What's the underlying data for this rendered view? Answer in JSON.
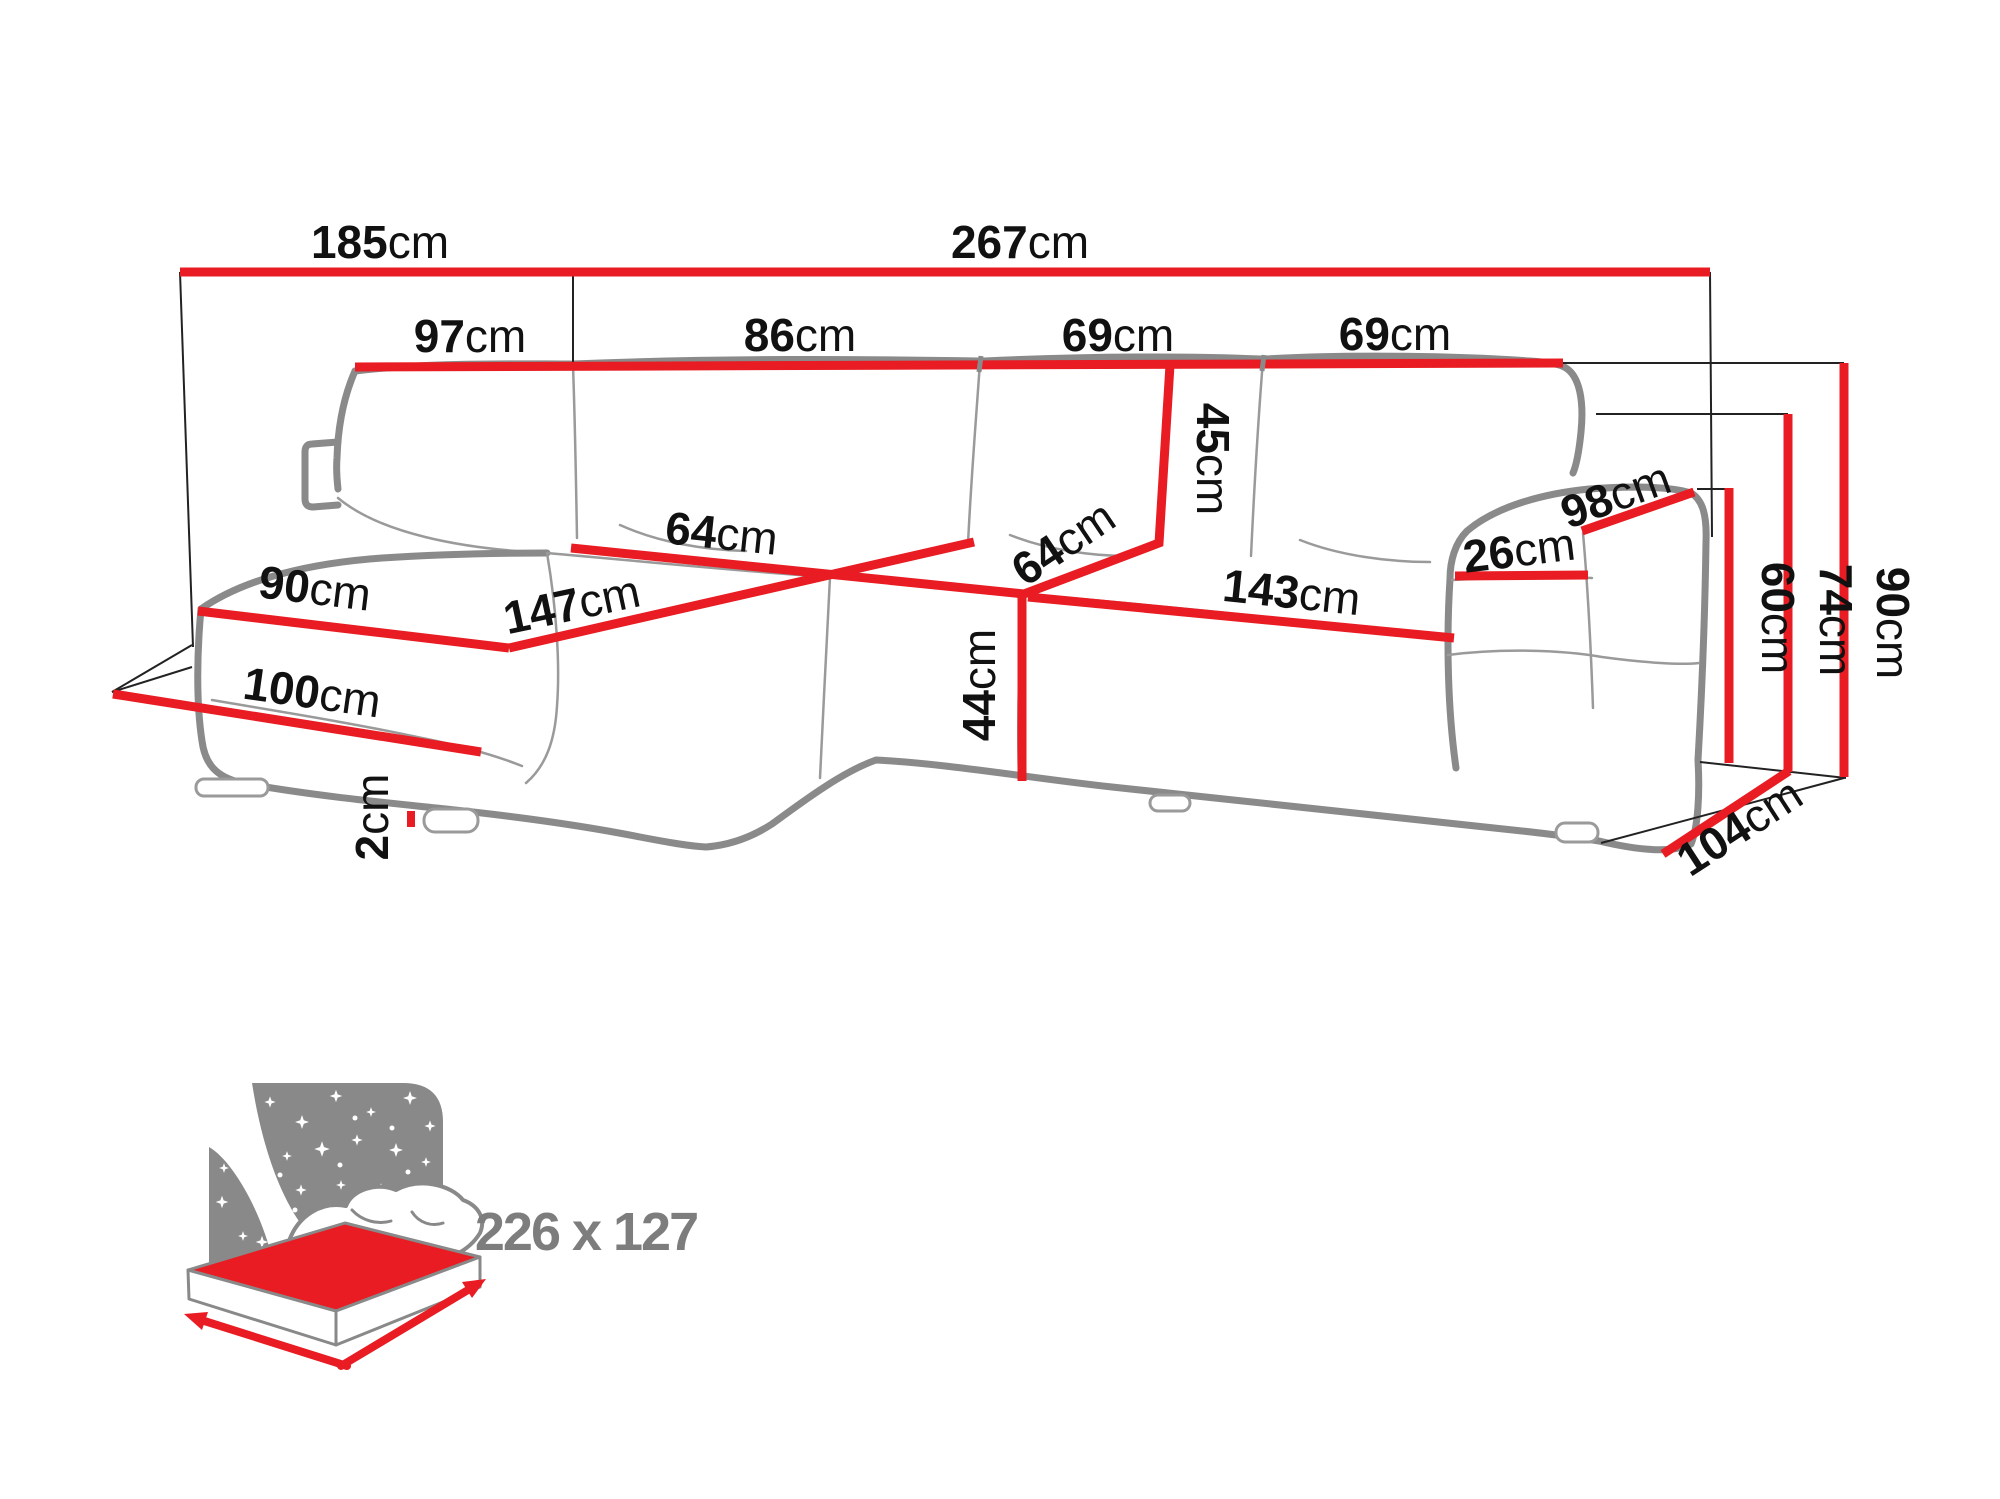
{
  "diagram": {
    "title": "corner sofa dimensions",
    "unit_system": "cm",
    "dimensions": [
      {
        "value": "185",
        "unit": "cm"
      },
      {
        "value": "267",
        "unit": "cm"
      },
      {
        "value": "97",
        "unit": "cm"
      },
      {
        "value": "86",
        "unit": "cm"
      },
      {
        "value": "69",
        "unit": "cm"
      },
      {
        "value": "69",
        "unit": "cm"
      },
      {
        "value": "45",
        "unit": "cm"
      },
      {
        "value": "64",
        "unit": "cm"
      },
      {
        "value": "64",
        "unit": "cm"
      },
      {
        "value": "147",
        "unit": "cm"
      },
      {
        "value": "90",
        "unit": "cm"
      },
      {
        "value": "100",
        "unit": "cm"
      },
      {
        "value": "44",
        "unit": "cm"
      },
      {
        "value": "143",
        "unit": "cm"
      },
      {
        "value": "26",
        "unit": "cm"
      },
      {
        "value": "98",
        "unit": "cm"
      },
      {
        "value": "2",
        "unit": "cm"
      },
      {
        "value": "60",
        "unit": "cm"
      },
      {
        "value": "74",
        "unit": "cm"
      },
      {
        "value": "90",
        "unit": "cm"
      },
      {
        "value": "104",
        "unit": "cm"
      }
    ],
    "sleeping_area": {
      "value": "226 x 127"
    },
    "colors": {
      "dimension_red": "#e81c22",
      "outline_gray": "#8a8a8a",
      "seam_gray": "#9a9a9a",
      "construction_black": "#222222",
      "label_black": "#111111",
      "icon_gray": "#898989",
      "size_text_gray": "#7d7d7d",
      "background": "#ffffff"
    }
  }
}
